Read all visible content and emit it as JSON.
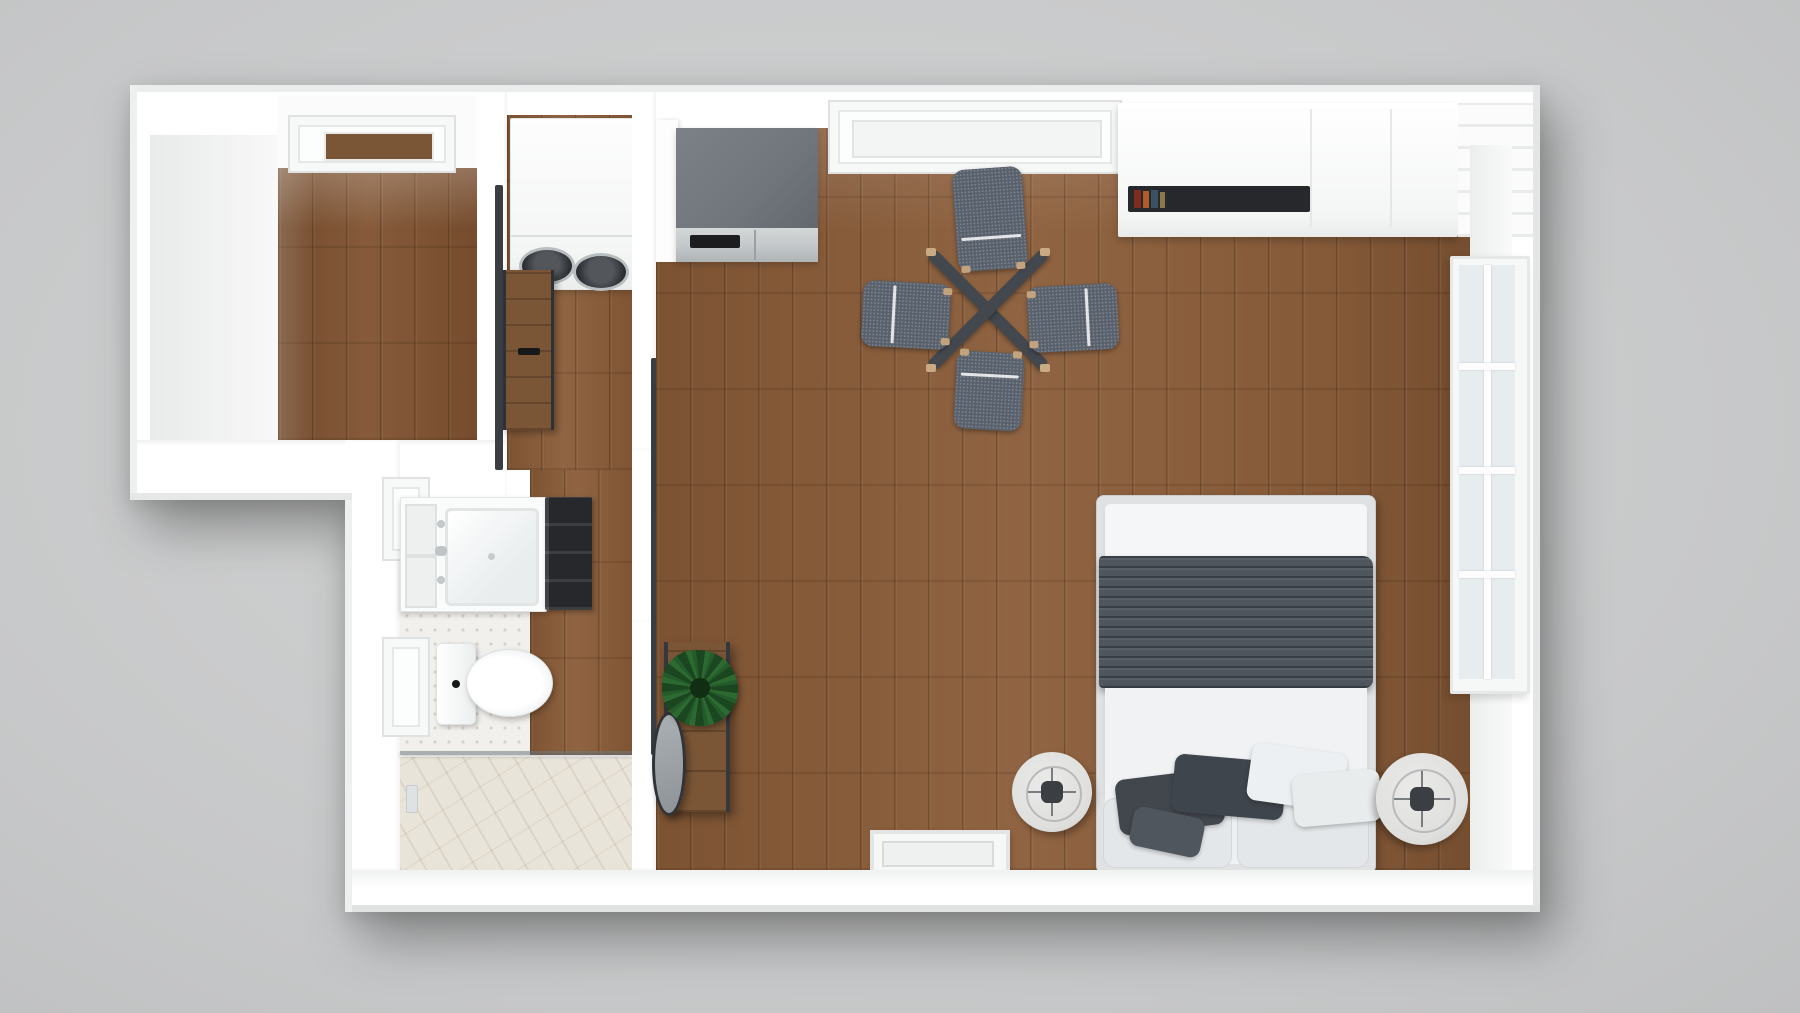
{
  "scene": {
    "type": "3d-floorplan-top-down-render",
    "description": "Photorealistic top-down 3D render of a studio apartment floor plan on a gray backdrop",
    "rooms": [
      {
        "id": "den",
        "label": "Den / walk-in room with window"
      },
      {
        "id": "laundry-closet",
        "label": "Laundry closet with stacked washer-dryer"
      },
      {
        "id": "bathroom",
        "label": "Bathroom with vanity, toilet and walk-in shower"
      },
      {
        "id": "hallway",
        "label": "Entry hallway with console, mirror and plant"
      },
      {
        "id": "main-room",
        "label": "Main living / sleeping room with kitchenette"
      }
    ],
    "furniture": {
      "washer_dryer": "Stacked washer-dryer unit",
      "kitchen_unit": "Kitchenette counter with stainless oven front",
      "wardrobe": "White wardrobe / media console with book niche",
      "dining_table": "X-base dining table",
      "dining_chairs": "4 upholstered gray dining chairs",
      "bed": "Double bed with white duvet, gray throw and pillows",
      "nightstands": "2 round drum nightstands with lamps",
      "console": "Narrow wood entry console",
      "mirror": "Leaning oval mirror",
      "plant": "Potted green plant",
      "vanity": "Bathroom vanity with sink",
      "toilet": "Toilet",
      "shower": "Glass-partition shower with marble floor",
      "barn_doors": "Dark-rail sliding wood doors",
      "right_window": "Divided-light window on right wall",
      "top_windows": "Recessed windows on top wall",
      "wall_vent": "Framed vent / low window on bottom wall"
    }
  },
  "colors": {
    "bg": "#c7c8c9",
    "wall": "#ffffff",
    "wall_face": "#eef0f0",
    "wood": "#8a5c38",
    "wood_den": "#7f5230",
    "tile": "#f1f0ec",
    "tile_dot": "#d6d3cb",
    "marble": "#e9e4da",
    "counter_gray": "#70767b",
    "steel": "#c3c7c9",
    "chair": "#59616d",
    "chair_pipe": "#f2f3f4",
    "table_dark": "#43484f",
    "throw": "#4f565e",
    "duvet": "#eef0f2",
    "bed_frame": "#dfe1e3",
    "pillow_dark": "#42474e",
    "pillow_light": "#edf0f2",
    "nightstand": "#dfdfdd",
    "lamp_dark": "#3b3e42",
    "glass": "#e7ecee",
    "rail_dark": "#3a3d42",
    "door_wood": "#7b5636",
    "plant_green": "#2c6a32",
    "plant_dark": "#1a4620",
    "niche_dark": "#26282b",
    "book_red": "#7e2d20",
    "book_orange": "#b05c2a",
    "book_blue": "#3c4f63",
    "mirror": "#9aa0a4"
  }
}
